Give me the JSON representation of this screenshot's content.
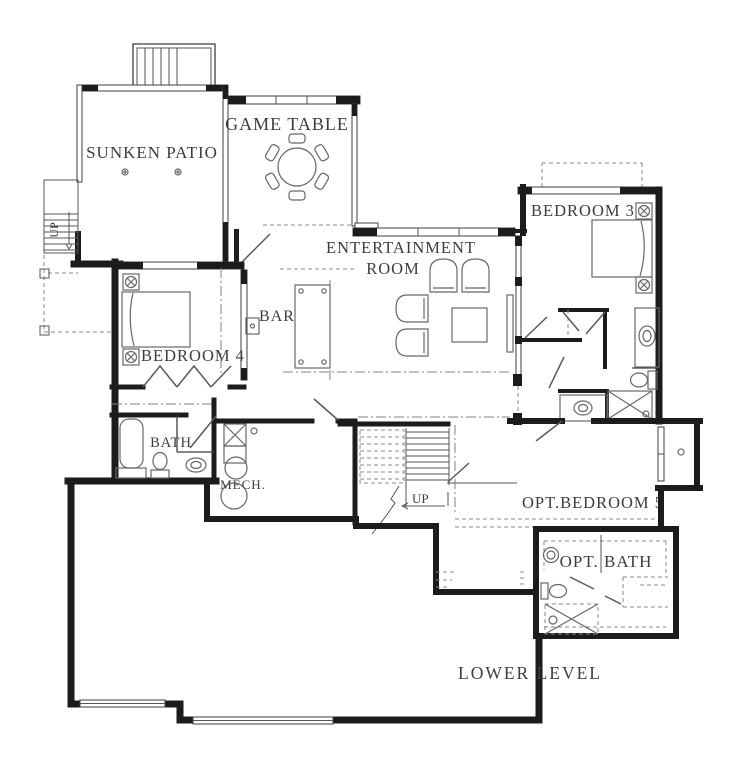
{
  "title": "LOWER LEVEL",
  "labels": {
    "sunken_patio": "SUNKEN PATIO",
    "game_table": "GAME TABLE",
    "entertainment_line1": "ENTERTAINMENT",
    "entertainment_line2": "ROOM",
    "bar": "BAR",
    "bedroom4": "BEDROOM 4",
    "bedroom3": "BEDROOM 3",
    "bath": "BATH",
    "mech": "MECH.",
    "up_left": "UP",
    "up_center": "UP",
    "opt_bedroom5": "OPT.BEDROOM 5",
    "opt_bath": "OPT. BATH",
    "lower_level": "LOWER LEVEL"
  },
  "colors": {
    "wall": "#1c1c1c",
    "thin_line": "#3f3f3f",
    "furniture_line": "#676767",
    "dashed_line": "#8a8a8a",
    "text": "#3d3d3d",
    "background": "#ffffff"
  },
  "symbols": [
    "deck-stairs",
    "exterior-stairs",
    "interior-stairs",
    "round-game-table",
    "dining-chair",
    "armchair",
    "coffee-table",
    "media-console",
    "bar-counter",
    "shuffleboard-table",
    "bed",
    "ceiling-fan",
    "bathtub",
    "toilet",
    "sink",
    "shower",
    "washer",
    "water-heater-tank",
    "window",
    "door-swing",
    "deck-post"
  ]
}
